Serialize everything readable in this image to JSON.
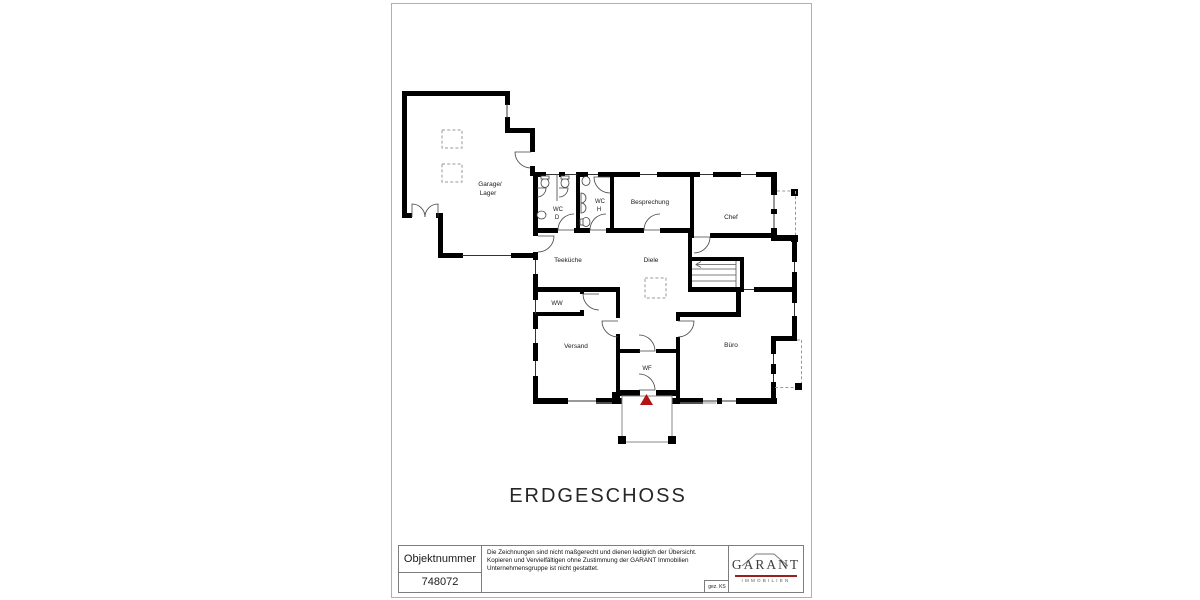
{
  "floor_plan": {
    "floor_title": "ERDGESCHOSS",
    "rooms": {
      "garage_line1": "Garage/",
      "garage_line2": "Lager",
      "wc_d_line1": "WC",
      "wc_d_line2": "D",
      "wc_h_line1": "WC",
      "wc_h_line2": "H",
      "besprechung": "Besprechung",
      "chef": "Chef",
      "teekueche": "Teeküche",
      "diele": "Diele",
      "ww": "WW",
      "versand": "Versand",
      "buero": "Büro",
      "wf": "WF"
    }
  },
  "title_block": {
    "object_number_label": "Objektnummer",
    "object_number": "748072",
    "disclaimer_line1": "Die Zeichnungen sind nicht maßgerecht und dienen lediglich der Übersicht.",
    "disclaimer_line2": "Kopieren und Vervielfältigen ohne Zustimmung der GARANT Immobilien",
    "disclaimer_line3": "Unternehmensgruppe ist nicht gestattet.",
    "signed": "gez. KS"
  },
  "logo": {
    "brand": "GARANT",
    "subtitle": "IMMOBILIEN"
  },
  "colors": {
    "wall": "#000000",
    "sheet_border": "#c7a6a6",
    "entrance_marker": "#b31312",
    "logo_accent": "#9a1f1f"
  }
}
